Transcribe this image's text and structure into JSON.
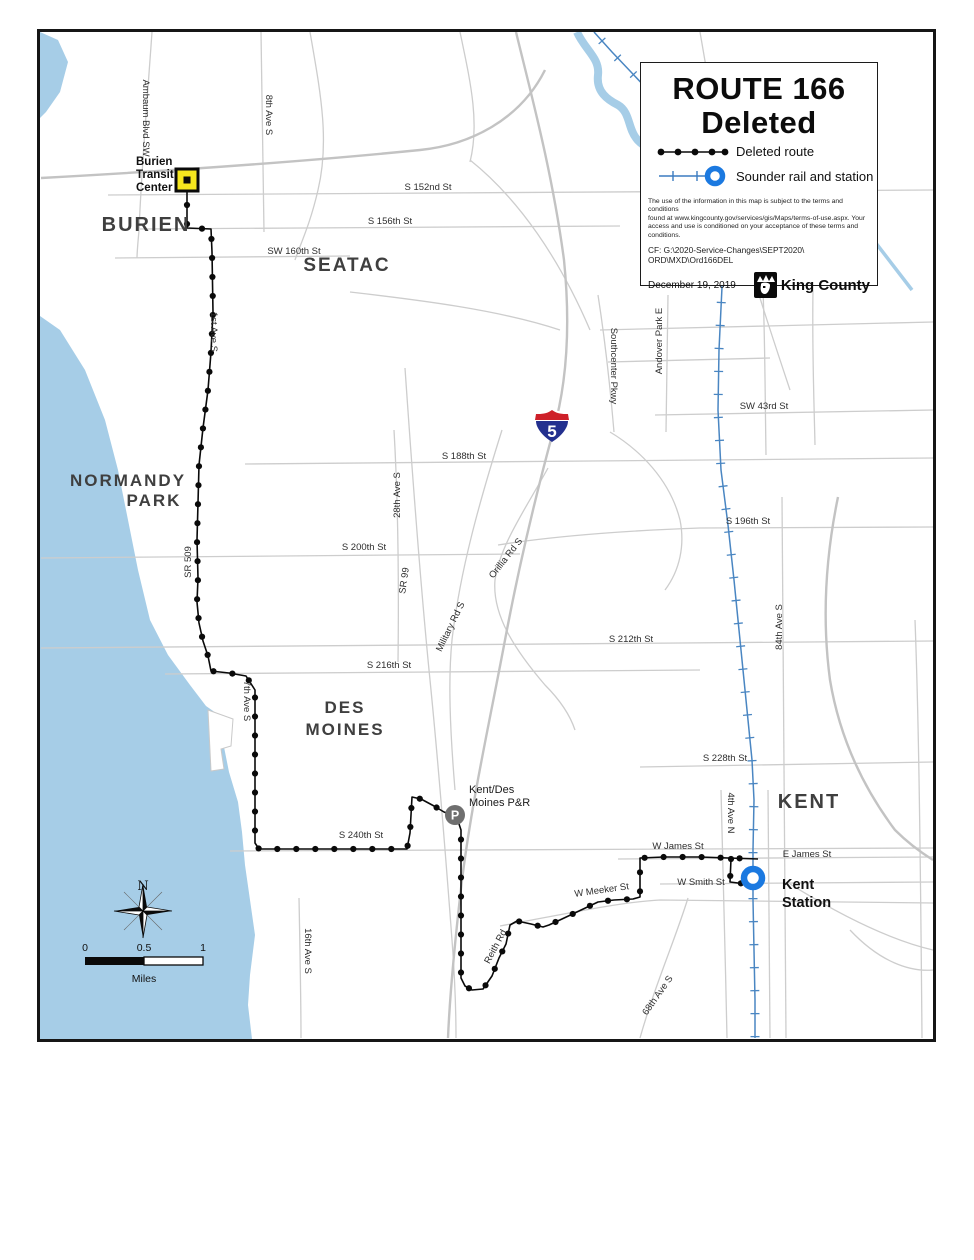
{
  "infobox": {
    "title1": "ROUTE 166",
    "title2": "Deleted",
    "legend": {
      "deleted": "Deleted route",
      "sounder": "Sounder rail and station"
    },
    "disclaimer1": "The use of the information in this map is subject to the terms and conditions",
    "disclaimer2": "found at www.kingcounty.gov/services/gis/Maps/terms-of-use.aspx. Your",
    "disclaimer3": "access and use is conditioned on your acceptance of these terms and conditions.",
    "cf1": "CF:  G:\\2020-Service-Changes\\SEPT2020\\",
    "cf2": "ORD\\MXD\\Ord166DEL",
    "date": "December 19, 2019",
    "logo": "King County"
  },
  "map": {
    "cities": {
      "burien": "BURIEN",
      "seatac": "SEATAC",
      "normandy1": "NORMANDY",
      "normandy2": "PARK",
      "desmoines1": "DES",
      "desmoines2": "MOINES",
      "kent": "KENT"
    },
    "streets": {
      "ambaum": "Ambaum Blvd SW",
      "ave8": "8th Ave S",
      "s152": "S 152nd St",
      "s156": "S 156th St",
      "sw160": "SW 160th St",
      "ave1": "1st Ave S",
      "sr509": "SR 509",
      "sw43": "SW 43rd St",
      "s188": "S 188th St",
      "s196": "S 196th St",
      "s200": "S 200th St",
      "sr99": "SR 99",
      "ave28": "28th Ave S",
      "military": "Military Rd S",
      "orillia": "Orillia Rd S",
      "southcenter": "Southcenter Pkwy",
      "andover": "Andover Park E",
      "s212": "S 212th St",
      "ave84": "84th Ave S",
      "s216": "S 216th St",
      "ave7": "7th Ave S",
      "s228": "S 228th St",
      "s240": "S 240th St",
      "wjames": "W James St",
      "ejames": "E James St",
      "ave4n": "4th Ave N",
      "wsmith": "W Smith St",
      "wmeeker": "W Meeker St",
      "reith": "Reith Rd",
      "ave16": "16th Ave S",
      "ave68": "68th Ave S"
    },
    "markers": {
      "btc1": "Burien",
      "btc2": "Transit",
      "btc3": "Center",
      "pnr1": "Kent/Des",
      "pnr2": "Moines P&R",
      "p": "P",
      "kent1": "Kent",
      "kent2": "Station"
    },
    "shield": "5",
    "compass_n": "N",
    "scalebar": {
      "zero": "0",
      "half": "0.5",
      "one": "1",
      "unit": "Miles"
    }
  },
  "colors": {
    "water": "#a6cde7",
    "route": "#0a0a0a",
    "rail": "#4a86c2",
    "station_ring": "#1b79e0",
    "road": "#cdcdcd",
    "btc_fill": "#f6e71e",
    "pnr_gray": "#6f6f6f",
    "shield_red": "#ce2029",
    "shield_blue": "#23308f"
  }
}
